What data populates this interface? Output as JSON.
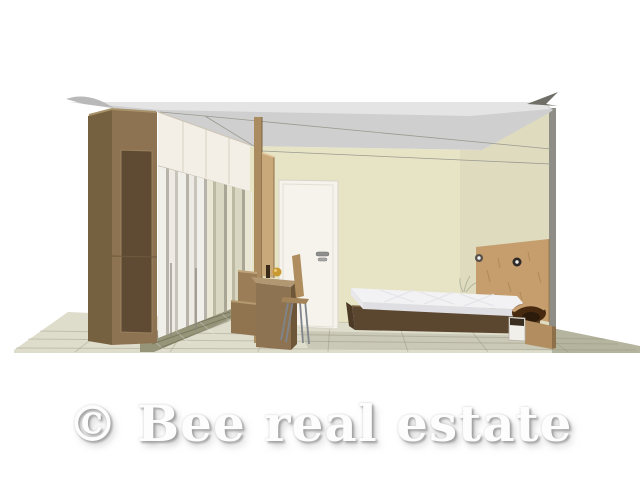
{
  "scene": {
    "description": "3D rendering of a bedroom interior shown in cutaway perspective",
    "watermark": {
      "text": "© Bee real estate",
      "text_color": "#ffffff",
      "shadow_color": "#aaaaaa"
    },
    "colors": {
      "bg": "#ffffff",
      "ceiling": "#cfcfcf",
      "ceiling_light": "#e4e4e4",
      "ceiling_flare": "#6f6f68",
      "wall": "#e7e4c6",
      "wall_edge": "#8e8e86",
      "floor": "#dedccb",
      "floor_right": "#b5b49e",
      "mosaic": "#96957a",
      "wood_side": "#75613f",
      "wood_front": "#8d7352",
      "wood_dark": "#5f4a33",
      "wood_top": "#a8926a",
      "cabinet_white": "#f3efe6",
      "pillar": "#ab8b60",
      "panel": "#c9a87a",
      "bench": "#9b7e58",
      "bench_low": "#8f744f",
      "desk_top": "#b29872",
      "desk_side": "#6e5738",
      "chair_wood": "#b08d5e",
      "metal": "#7f858b",
      "platform": "#5b4630",
      "platform_end": "#4c3a27",
      "mattress_top": "#f2f2f4",
      "mattress_side": "#dfdfe3",
      "mattress_end": "#e8e8ec",
      "headboard": "#c69e6e",
      "nightstand": "#b28d60",
      "nightstand_side": "#8d6f4a",
      "roll_dark": "#46290f",
      "drawer_white": "#f1efe9",
      "door": "#f5f3ec",
      "door_edge": "#d8d4c8",
      "handle": "#8f8f8d",
      "gold_ornament": "#c89a30",
      "shadow": "rgba(110,110,90,0.18)"
    },
    "closet": {
      "stripe_colors_front": [
        "#f1efe9",
        "#b7b3ab",
        "#edebe3",
        "#c8c4bb"
      ],
      "stripe_colors_back": [
        "#d9d6c2",
        "#a9a696",
        "#e9e6d4",
        "#bdbaa4"
      ]
    },
    "objects": [
      "ceiling",
      "back-wall",
      "tiled-floor",
      "mosaic-walkway",
      "wardrobe",
      "upper-cabinets",
      "closet-sliding-doors",
      "partition-pillar",
      "partition-panel",
      "bench",
      "desk",
      "desk-chair",
      "interior-door",
      "door-handle",
      "bed-platform",
      "mattress",
      "headboard-panel",
      "wall-lamp-left",
      "wall-lamp-right",
      "nightstand",
      "gold-ornament",
      "watermark"
    ]
  }
}
